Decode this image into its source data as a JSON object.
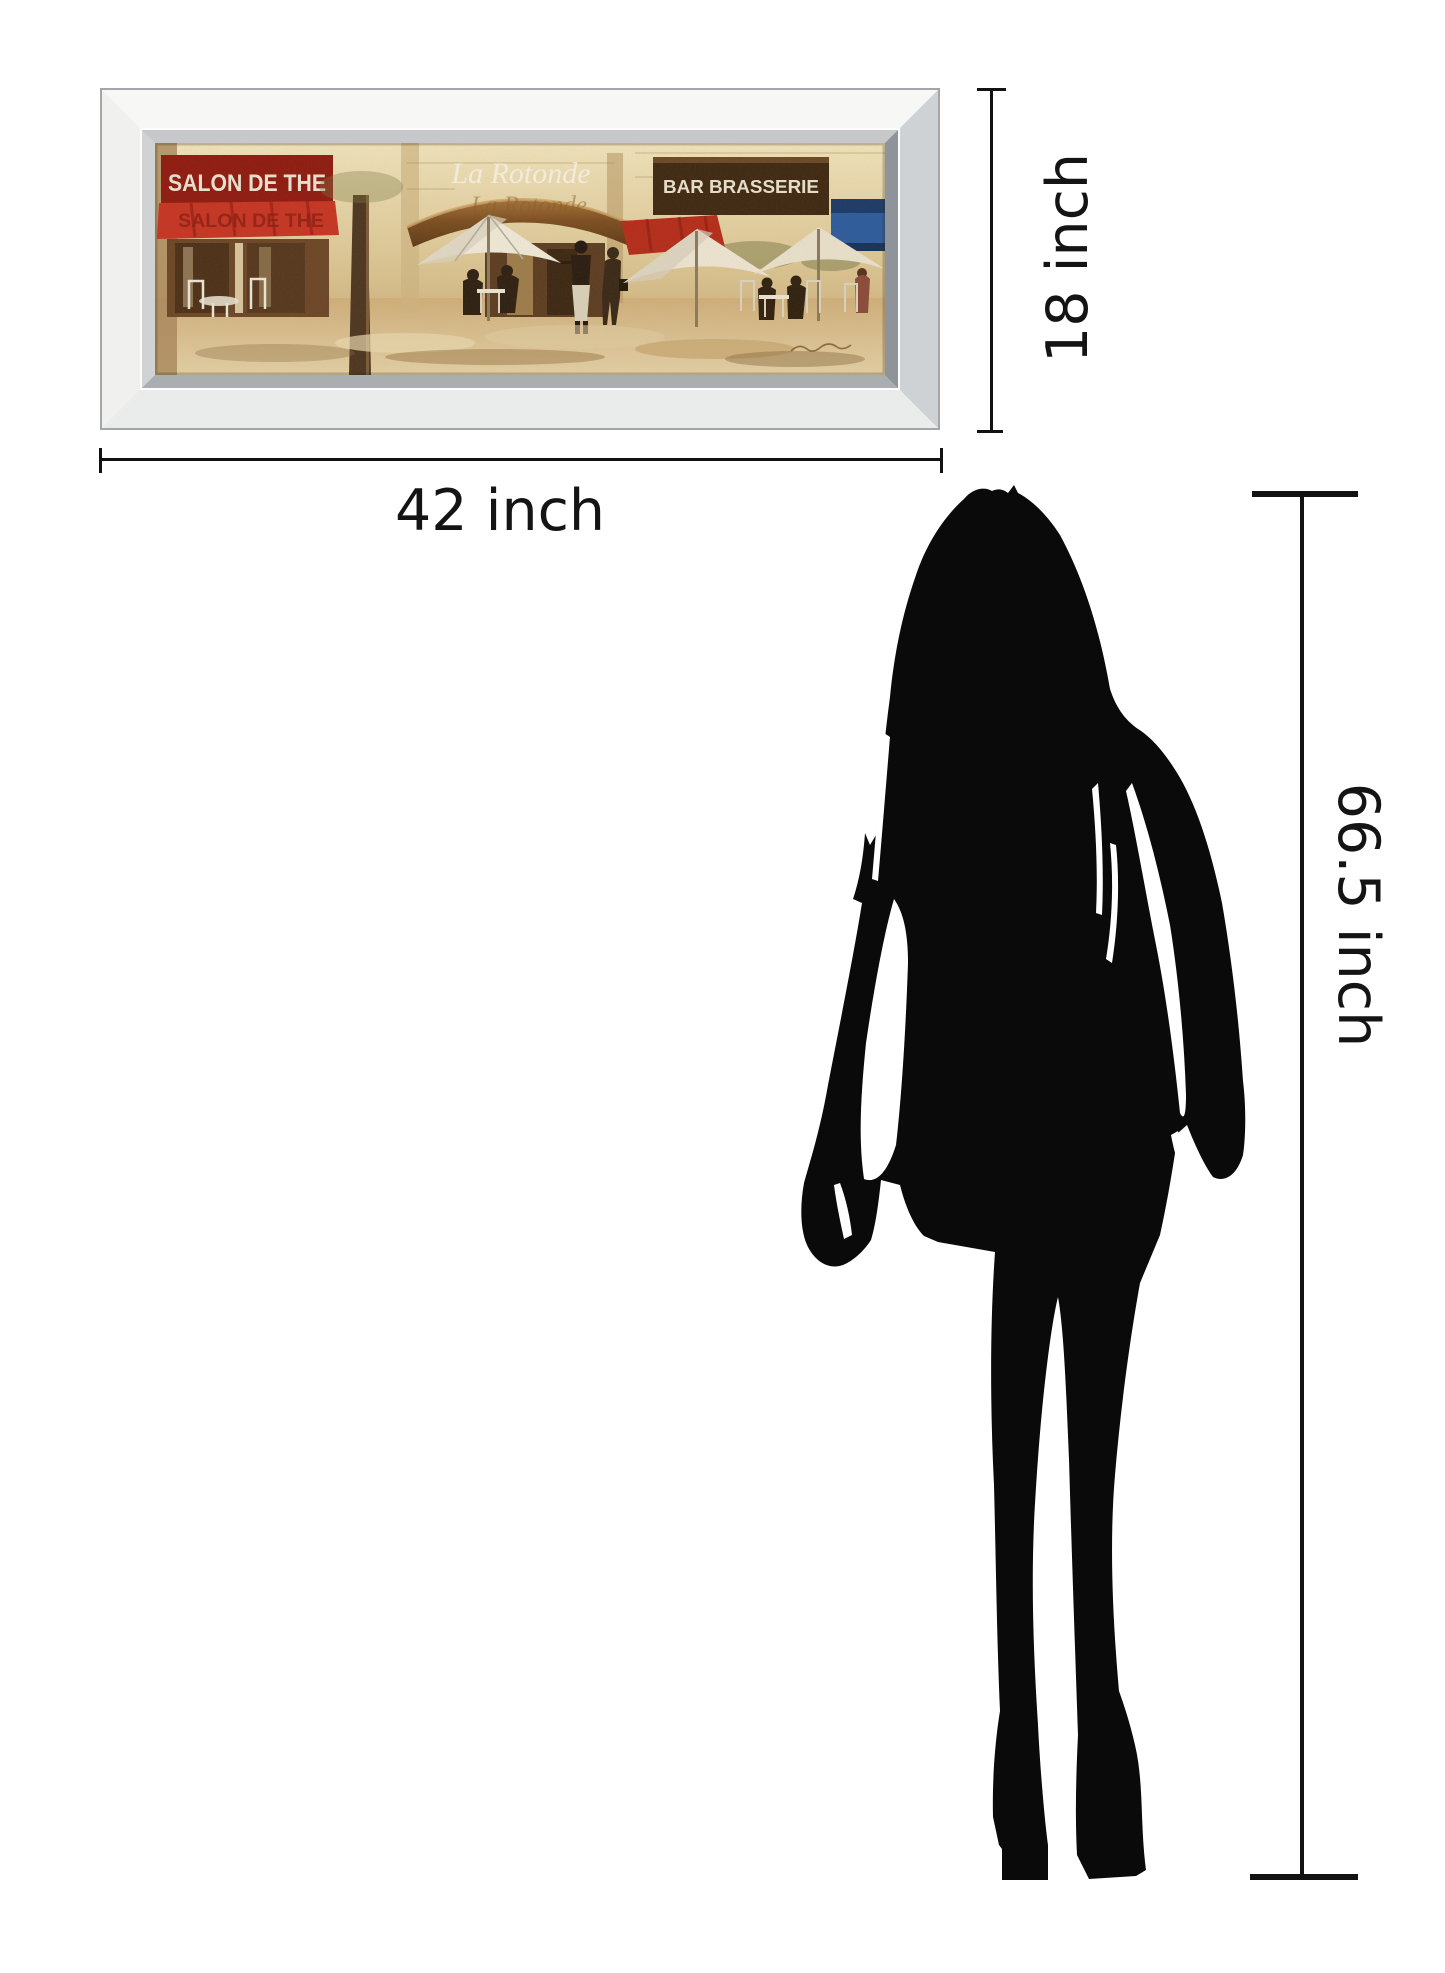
{
  "framed_art": {
    "description": "mirror framed Paris cafe painting",
    "signs": {
      "left": "SALON DE THE",
      "center": "La Rotonde",
      "right": "BAR BRASSERIE"
    }
  },
  "dimension_annotations": {
    "frame_width": "42 inch",
    "frame_height": "18 inch",
    "figure_height": "66.5 inch"
  },
  "colors": {
    "annotation_ink": "#121212",
    "silhouette": "#0a0a0a",
    "frame_face": "#f4f4f2",
    "frame_bevel": "#8e9499",
    "sign_red": "#8e1a10",
    "awning_red": "#c53423",
    "sign_brown": "#3f2812",
    "panel_blue": "#2d5b9d",
    "wall_cream": "#dcc695",
    "ground_tan": "#cfae79"
  }
}
